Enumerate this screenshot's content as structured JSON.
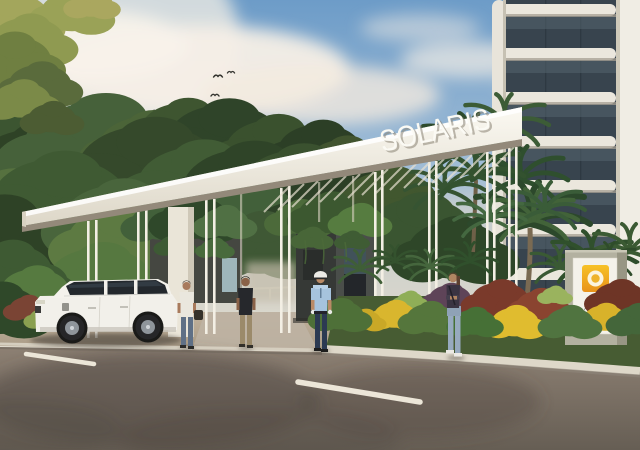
{
  "image": {
    "kind": "3d-architectural-rendering",
    "subject": "SOLARIS residential development entrance gate"
  },
  "text": {
    "canopy_sign": "SOLARIS",
    "pylon_sign": "SOLARIS"
  },
  "palette": {
    "sky_top": "#6d9cc8",
    "sky_horizon": "#e6dfd2",
    "cloud_white": "#f6efe6",
    "canopy_white": "#f5f2ea",
    "canopy_underside": "#93897a",
    "foliage_dark": "#2f4529",
    "foliage_light": "#8aa04e",
    "guard_house_charcoal": "#3c403e",
    "road_asphalt": "#85796d",
    "road_shadow": "#4f4841",
    "lane_line": "#ece6d8",
    "curb": "#ded8c9",
    "logo_yellow": "#efa41f",
    "logo_text_gray": "#85857f",
    "tower_glass": "#38444e",
    "tower_wall": "#ebe7dd",
    "suv_body": "#f2f0ea",
    "suv_glass": "#23282d",
    "guard_shirt_blue": "#a6c3dd",
    "guard_pants_navy": "#2c3a52",
    "woman_jeans": "#97aabf"
  }
}
